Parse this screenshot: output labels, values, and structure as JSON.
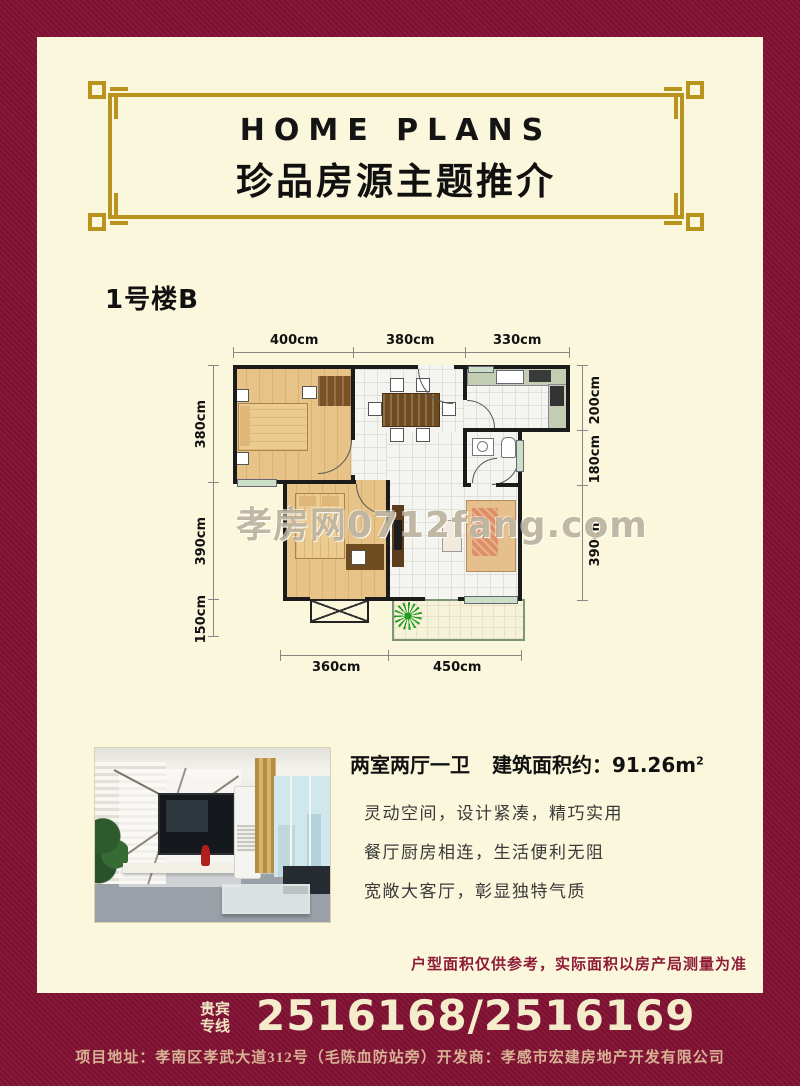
{
  "header": {
    "title_en": "HOME  PLANS",
    "title_zh": "珍品房源主题推介"
  },
  "unit": {
    "label": "1号楼B"
  },
  "floorplan": {
    "dims_top": [
      "400cm",
      "380cm",
      "330cm"
    ],
    "dims_left": [
      "380cm",
      "390cm",
      "150cm"
    ],
    "dims_right": [
      "200cm",
      "180cm",
      "390cm"
    ],
    "dims_bottom": [
      "360cm",
      "450cm"
    ],
    "watermark": "孝房网0712fang.com"
  },
  "info": {
    "summary_rooms": "两室两厅一卫",
    "summary_area_label": "建筑面积约：",
    "summary_area_value": "91.26m",
    "summary_area_sup": "2",
    "desc_lines": [
      "灵动空间，设计紧凑，精巧实用",
      "餐厅厨房相连，生活便利无阻",
      "宽敞大客厅，彰显独特气质"
    ]
  },
  "disclaimer": "户型面积仅供参考，实际面积以房产局测量为准",
  "hotline": {
    "label_line1": "贵宾",
    "label_line2": "专线",
    "numbers": "2516168/2516169"
  },
  "footer": {
    "address": "项目地址：孝南区孝武大道312号（毛陈血防站旁）开发商：孝感市宏建房地产开发有限公司"
  },
  "colors": {
    "maroon": "#7A1130",
    "cream": "#FBF7DC",
    "frame_gold": "#B8941F",
    "phone_cream": "#F4ECCB",
    "address_gold": "#D8B294",
    "disclaimer_red": "#8E1C38"
  }
}
